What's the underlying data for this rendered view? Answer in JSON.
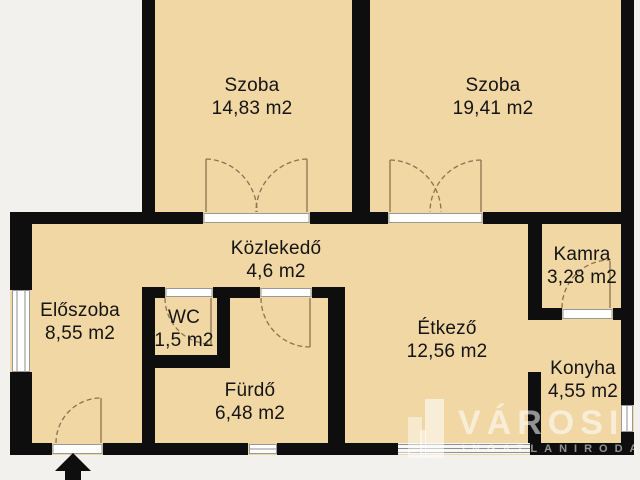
{
  "meta": {
    "kind": "apartment-floor-plan"
  },
  "rooms": [
    {
      "id": "szoba-1",
      "name": "Szoba",
      "area": "14,83 m2"
    },
    {
      "id": "szoba-2",
      "name": "Szoba",
      "area": "19,41 m2"
    },
    {
      "id": "kozlekedo",
      "name": "Közlekedő",
      "area": "4,6 m2"
    },
    {
      "id": "kamra",
      "name": "Kamra",
      "area": "3,28 m2"
    },
    {
      "id": "eloszoba",
      "name": "Előszoba",
      "area": "8,55 m2"
    },
    {
      "id": "wc",
      "name": "WC",
      "area": "1,5 m2"
    },
    {
      "id": "etkezo",
      "name": "Étkező",
      "area": "12,56 m2"
    },
    {
      "id": "furdo",
      "name": "Fürdő",
      "area": "6,48 m2"
    },
    {
      "id": "konyha",
      "name": "Konyha",
      "area": "4,55 m2"
    }
  ],
  "watermark": {
    "brand": "VÁROSI",
    "tagline": "INGATLANIRODA"
  },
  "colors": {
    "floor": "#f0d7a4",
    "wall": "#0e0e0e",
    "exterior": "#f3f1ee",
    "door": "#8a744d",
    "ink": "#141414"
  }
}
